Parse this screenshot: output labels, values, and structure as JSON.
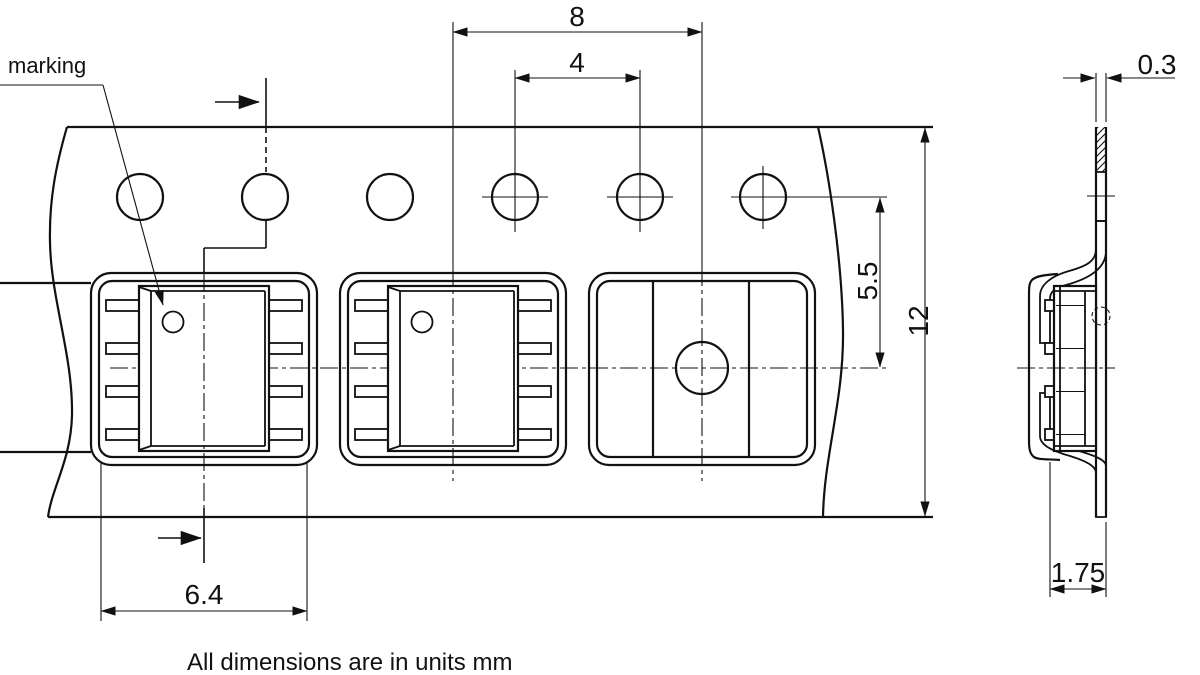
{
  "drawing": {
    "labels": {
      "marking": "marking"
    },
    "note": "All dimensions are in units mm",
    "dimensions": {
      "pocket_pitch": "8",
      "sprocket_hole_pitch": "4",
      "hole_to_pocket_center": "5.5",
      "tape_width": "12",
      "tape_thickness": "0.3",
      "pocket_width": "6.4",
      "pocket_depth": "1.75"
    },
    "colors": {
      "line": "#111111",
      "background": "#ffffff"
    }
  }
}
